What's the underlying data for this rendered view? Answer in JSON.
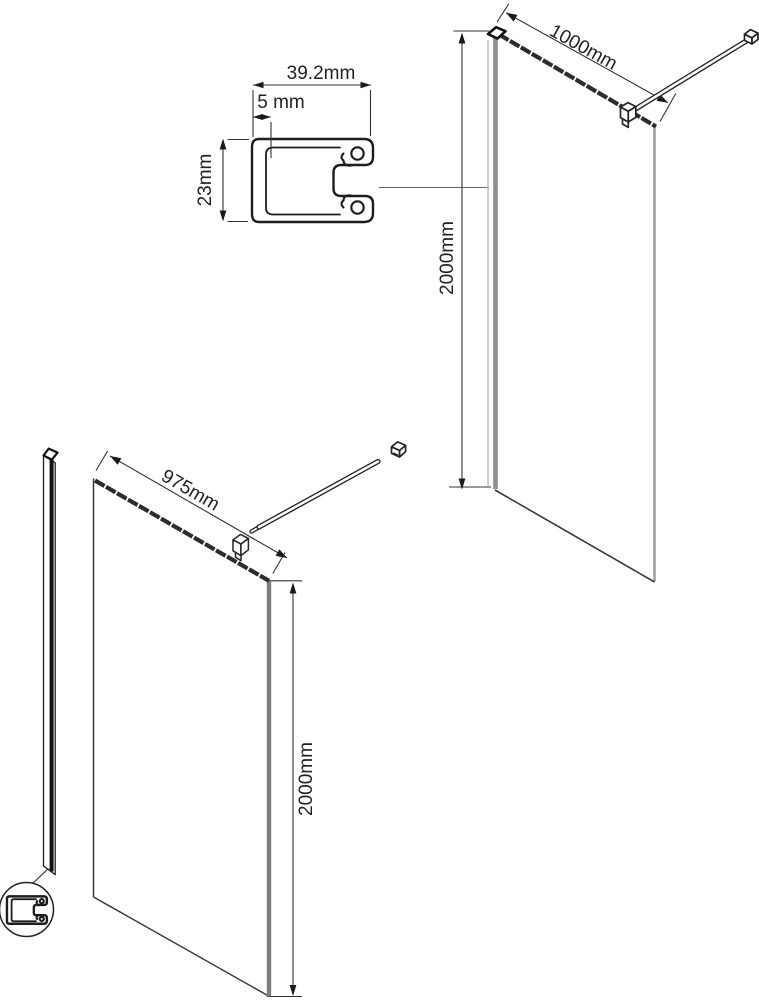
{
  "labels": {
    "profile_width": "39.2mm",
    "profile_slot": "5 mm",
    "profile_depth": "23mm",
    "assembled_width": "1000mm",
    "assembled_height": "2000mm",
    "glass_width": "975mm",
    "glass_height": "2000mm"
  },
  "colors": {
    "line": "#231f20",
    "glass_edge_gray": "#8a8a8a",
    "background": "#ffffff"
  }
}
